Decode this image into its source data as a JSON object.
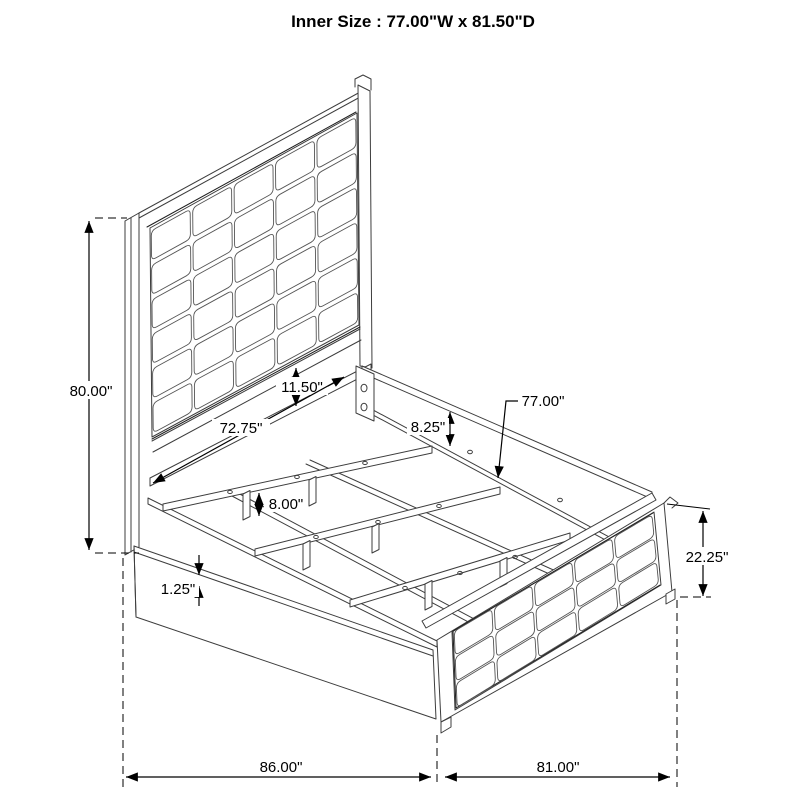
{
  "title": "Inner Size : 77.00\"W x 81.50\"D",
  "diagram": {
    "headboard": {
      "columns": 5,
      "rows": 6
    },
    "footboard": {
      "columns": 5,
      "rows": 3
    }
  },
  "dims": [
    {
      "name": "headboard-height",
      "label": "80.00\""
    },
    {
      "name": "panel-to-rail-gap",
      "label": "11.50\""
    },
    {
      "name": "inner-rail-length",
      "label": "72.75\""
    },
    {
      "name": "side-rail-height",
      "label": "8.25\""
    },
    {
      "name": "slat-length",
      "label": "77.00\""
    },
    {
      "name": "support-leg-height",
      "label": "8.00\""
    },
    {
      "name": "rail-lip-thickness",
      "label": "1.25\""
    },
    {
      "name": "footboard-height",
      "label": "22.25\""
    },
    {
      "name": "overall-depth",
      "label": "86.00\""
    },
    {
      "name": "overall-width",
      "label": "81.00\""
    }
  ]
}
